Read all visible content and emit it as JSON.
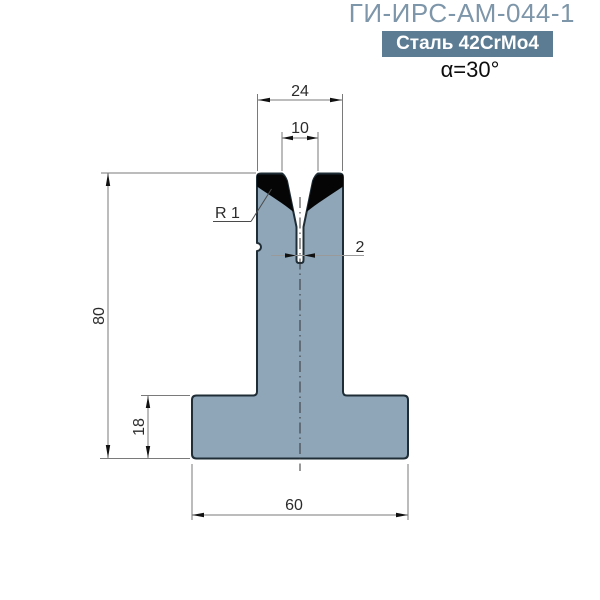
{
  "header": {
    "title": "ГИ-ИРС-АМ-044-1",
    "material": "Сталь 42CrMo4",
    "angle": "α=30°"
  },
  "dimensions": {
    "shoulder_width": "24",
    "v_opening": "10",
    "shoulder_radius": "R 1",
    "slot_width": "2",
    "total_height": "80",
    "base_height": "18",
    "base_width": "60"
  },
  "drawing": {
    "type": "press-brake-t-die-cross-section",
    "units": "mm",
    "colors": {
      "body_fill": "#8EA6B8",
      "body_outline": "#1F2D36",
      "hardened_zone": "#050505",
      "title_text": "#7E96A9",
      "badge_bg": "#5C7C93",
      "badge_text": "#FFFFFF",
      "dimension_lines": "#7A7A7A"
    }
  }
}
